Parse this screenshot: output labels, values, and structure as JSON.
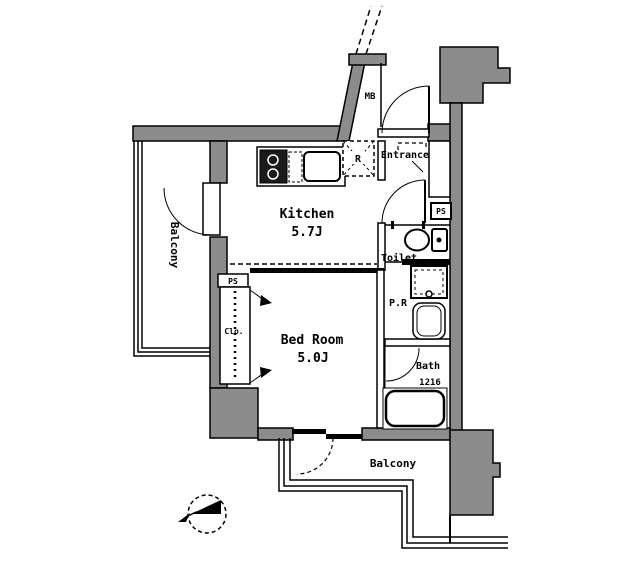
{
  "floor_plan": {
    "rooms": {
      "kitchen": {
        "name": "Kitchen",
        "size": "5.7J"
      },
      "bedroom": {
        "name": "Bed Room",
        "size": "5.0J"
      },
      "balcony_left": {
        "name": "Balcony"
      },
      "balcony_bottom": {
        "name": "Balcony"
      },
      "entrance": {
        "name": "Entrance"
      },
      "toilet": {
        "name": "Toilet"
      },
      "powder_room": {
        "name": "P.R"
      },
      "bath": {
        "name": "Bath",
        "size": "1216"
      },
      "closet": {
        "name": "Clo."
      }
    },
    "labels": {
      "meter_box": "MB",
      "pipe_space_right": "PS",
      "pipe_space_left": "PS",
      "refrigerator": "R"
    },
    "icons": {
      "compass": "compass-north-icon"
    },
    "colors": {
      "wall": "#8c8c8c",
      "line": "#000000",
      "background": "#ffffff"
    }
  }
}
